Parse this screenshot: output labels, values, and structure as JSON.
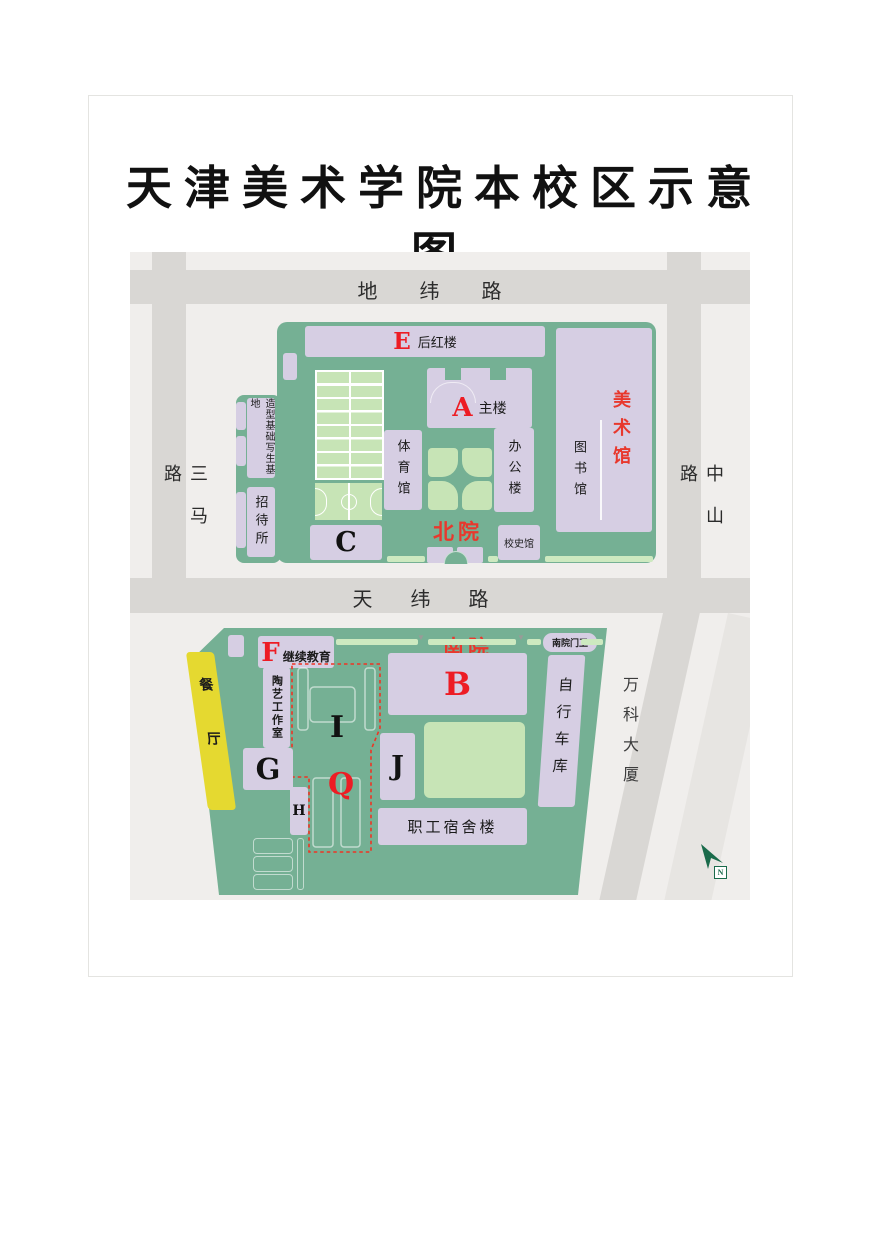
{
  "title": "天津美术学院本校区示意图",
  "roads": {
    "top": "地纬路",
    "middle": "天纬路",
    "left": "三马路",
    "right": "中山路"
  },
  "landmark": "万科大厦",
  "north": {
    "label": "北院",
    "rear_red_letter": "E",
    "rear_red_name": "后红楼",
    "main_letter": "A",
    "main_name": "主楼",
    "gym": "体育馆",
    "office": "办公楼",
    "library": "图书馆",
    "art_museum": "美术馆",
    "sketch_base": "造型基础写生基地",
    "guest_house": "招待所",
    "c_letter": "C",
    "history_museum": "校史馆"
  },
  "south": {
    "label": "南院",
    "gate_guard": "南院门卫",
    "f_letter": "F",
    "f_name": "继续教育",
    "b_letter": "B",
    "dining_hall": "餐厅",
    "pottery_studio": "陶艺工作室",
    "bike_garage": "自行车库",
    "i_letter": "I",
    "q_letter": "Q",
    "g_letter": "G",
    "h_letter": "H",
    "j_letter": "J",
    "staff_dorm": "职工宿舍楼"
  },
  "compass": "N",
  "colors": {
    "campus_green": "#75b094",
    "building_lavender": "#d6cee3",
    "court_green": "#c7e4b6",
    "road_gray": "#d9d7d4",
    "map_background": "#f0eeec",
    "dining_yellow": "#e5d930",
    "letter_red": "#ed1c24",
    "label_red": "#e8382d",
    "letter_black": "#121212"
  }
}
